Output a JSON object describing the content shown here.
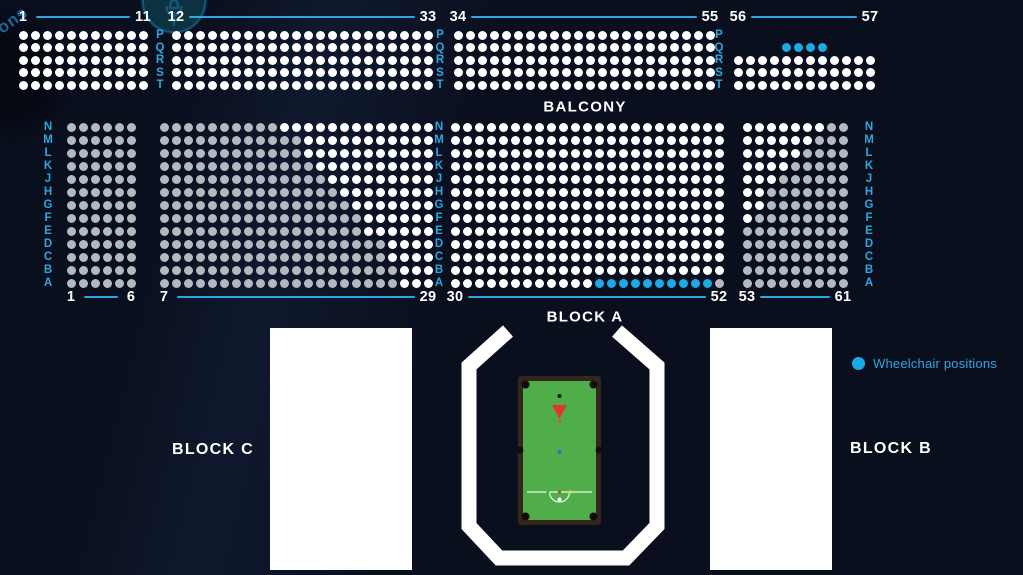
{
  "colors": {
    "background": "#0a0f1e",
    "accent_blue": "#2da7e0",
    "seat_available": "#ffffff",
    "seat_unavailable": "#b4b8bf",
    "seat_wheelchair": "#1da9e6",
    "block_fill": "#ffffff",
    "arena_outline": "#ffffff",
    "table_felt": "#4fae4a",
    "table_frame": "#35261b",
    "triangle_red": "#e0392b"
  },
  "labels": {
    "balcony": "BALCONY",
    "block_a": "BLOCK A",
    "block_b": "BLOCK B",
    "block_c": "BLOCK C"
  },
  "legend": {
    "wheelchair_label": "Wheelchair positions"
  },
  "watermark": {
    "text": "ions"
  },
  "seat_map": {
    "sections": [
      {
        "id": "balcony-1-11",
        "first_label": "1",
        "last_label": "11",
        "x": 23,
        "y": 35,
        "pitch_x": 12,
        "pitch_y": 12.5,
        "label_y": 17,
        "rows": [
          {
            "row": "P",
            "seats": "WWWWWWWWWWW"
          },
          {
            "row": "Q",
            "seats": "WWWWWWWWWWW"
          },
          {
            "row": "R",
            "seats": "WWWWWWWWWWW"
          },
          {
            "row": "S",
            "seats": "WWWWWWWWWWW"
          },
          {
            "row": "T",
            "seats": "WWWWWWWWWWW"
          }
        ]
      },
      {
        "id": "balcony-12-33",
        "first_label": "12",
        "last_label": "33",
        "x": 176,
        "y": 35,
        "pitch_x": 12,
        "pitch_y": 12.5,
        "label_y": 17,
        "rows": [
          {
            "row": "P",
            "seats": "WWWWWWWWWWWWWWWWWWWWWW"
          },
          {
            "row": "Q",
            "seats": "WWWWWWWWWWWWWWWWWWWWWW"
          },
          {
            "row": "R",
            "seats": "WWWWWWWWWWWWWWWWWWWWWW"
          },
          {
            "row": "S",
            "seats": "WWWWWWWWWWWWWWWWWWWWWW"
          },
          {
            "row": "T",
            "seats": "WWWWWWWWWWWWWWWWWWWWWW"
          }
        ]
      },
      {
        "id": "balcony-34-55",
        "first_label": "34",
        "last_label": "55",
        "x": 458,
        "y": 35,
        "pitch_x": 12,
        "pitch_y": 12.5,
        "label_y": 17,
        "rows": [
          {
            "row": "P",
            "seats": "WWWWWWWWWWWWWWWWWWWWWW"
          },
          {
            "row": "Q",
            "seats": "WWWWWWWWWWWWWWWWWWWWWW"
          },
          {
            "row": "R",
            "seats": "WWWWWWWWWWWWWWWWWWWWWW"
          },
          {
            "row": "S",
            "seats": "WWWWWWWWWWWWWWWWWWWWWW"
          },
          {
            "row": "T",
            "seats": "WWWWWWWWWWWWWWWWWWWWWW"
          }
        ]
      },
      {
        "id": "balcony-56-57",
        "first_label": "56",
        "last_label": "57",
        "x": 738,
        "y": 35,
        "pitch_x": 12,
        "pitch_y": 12.5,
        "label_y": 17,
        "rows": [
          {
            "row": "P",
            "seats": ""
          },
          {
            "row": "Q",
            "seats": "....BBBB"
          },
          {
            "row": "R",
            "seats": "WWWWWWWWWWWW"
          },
          {
            "row": "S",
            "seats": "WWWWWWWWWWWW"
          },
          {
            "row": "T",
            "seats": "WWWWWWWWWWWW"
          }
        ]
      },
      {
        "id": "floor-1-6",
        "first_label": "1",
        "last_label": "6",
        "x": 71,
        "y": 127,
        "pitch_x": 12,
        "pitch_y": 13,
        "label_y": 297,
        "rows": [
          {
            "row": "N",
            "seats": "GGGGGG"
          },
          {
            "row": "M",
            "seats": "GGGGGG"
          },
          {
            "row": "L",
            "seats": "GGGGGG"
          },
          {
            "row": "K",
            "seats": "GGGGGG"
          },
          {
            "row": "J",
            "seats": "GGGGGG"
          },
          {
            "row": "H",
            "seats": "GGGGGG"
          },
          {
            "row": "G",
            "seats": "GGGGGG"
          },
          {
            "row": "F",
            "seats": "GGGGGG"
          },
          {
            "row": "E",
            "seats": "GGGGGG"
          },
          {
            "row": "D",
            "seats": "GGGGGG"
          },
          {
            "row": "C",
            "seats": "GGGGGG"
          },
          {
            "row": "B",
            "seats": "GGGGGG"
          },
          {
            "row": "A",
            "seats": "GGGGGG"
          }
        ]
      },
      {
        "id": "floor-7-29",
        "first_label": "7",
        "last_label": "29",
        "x": 164,
        "y": 127,
        "pitch_x": 12,
        "pitch_y": 13,
        "label_y": 297,
        "rows": [
          {
            "row": "N",
            "seats": "GGGGGGGGGGWWWWWWWWWWWWW"
          },
          {
            "row": "M",
            "seats": "GGGGGGGGGGGGWWWWWWWWWWW"
          },
          {
            "row": "L",
            "seats": "GGGGGGGGGGGGWWWWWWWWWWW"
          },
          {
            "row": "K",
            "seats": "GGGGGGGGGGGGGWWWWWWWWWW"
          },
          {
            "row": "J",
            "seats": "GGGGGGGGGGGGGGWWWWWWWWW"
          },
          {
            "row": "H",
            "seats": "GGGGGGGGGGGGGGGWWWWWWWW"
          },
          {
            "row": "G",
            "seats": "GGGGGGGGGGGGGGGGWWWWWWW"
          },
          {
            "row": "F",
            "seats": "GGGGGGGGGGGGGGGGGWWWWWW"
          },
          {
            "row": "E",
            "seats": "GGGGGGGGGGGGGGGGGWWWWWW"
          },
          {
            "row": "D",
            "seats": "GGGGGGGGGGGGGGGGGGGWWWW"
          },
          {
            "row": "C",
            "seats": "GGGGGGGGGGGGGGGGGGGWWWW"
          },
          {
            "row": "B",
            "seats": "GGGGGGGGGGGGGGGGGGGGWWW"
          },
          {
            "row": "A",
            "seats": "GGGGGGGGGGGGGGGGGGGGWWW"
          }
        ]
      },
      {
        "id": "floor-30-52",
        "first_label": "30",
        "last_label": "52",
        "x": 455,
        "y": 127,
        "pitch_x": 12,
        "pitch_y": 13,
        "label_y": 297,
        "rows": [
          {
            "row": "N",
            "seats": "WWWWWWWWWWWWWWWWWWWWWWW"
          },
          {
            "row": "M",
            "seats": "WWWWWWWWWWWWWWWWWWWWWWW"
          },
          {
            "row": "L",
            "seats": "WWWWWWWWWWWWWWWWWWWWWWW"
          },
          {
            "row": "K",
            "seats": "WWWWWWWWWWWWWWWWWWWWWWW"
          },
          {
            "row": "J",
            "seats": "WWWWWWWWWWWWWWWWWWWWWWW"
          },
          {
            "row": "H",
            "seats": "WWWWWWWWWWWWWWWWWWWWWWW"
          },
          {
            "row": "G",
            "seats": "WWWWWWWWWWWWWWWWWWWWWWW"
          },
          {
            "row": "F",
            "seats": "WWWWWWWWWWWWWWWWWWWWWWW"
          },
          {
            "row": "E",
            "seats": "WWWWWWWWWWWWWWWWWWWWWWW"
          },
          {
            "row": "D",
            "seats": "WWWWWWWWWWWWWWWWWWWWWWW"
          },
          {
            "row": "C",
            "seats": "WWWWWWWWWWWWWWWWWWWWWWW"
          },
          {
            "row": "B",
            "seats": "WWWWWWWWWWWWWWWWWWWWWWW"
          },
          {
            "row": "A",
            "seats": "WWWWWWWWWWWWBBBBBBBBBBG"
          }
        ]
      },
      {
        "id": "floor-53-61",
        "first_label": "53",
        "last_label": "61",
        "x": 747,
        "y": 127,
        "pitch_x": 12,
        "pitch_y": 13,
        "label_y": 297,
        "rows": [
          {
            "row": "N",
            "seats": "WWWWWWWGG"
          },
          {
            "row": "M",
            "seats": "WWWWWWGGG"
          },
          {
            "row": "L",
            "seats": "WWWWWGGGG"
          },
          {
            "row": "K",
            "seats": "WWWWGGGGG"
          },
          {
            "row": "J",
            "seats": "WWWGGGGGG"
          },
          {
            "row": "H",
            "seats": "WWGGGGGGG"
          },
          {
            "row": "G",
            "seats": "WWGGGGGGG"
          },
          {
            "row": "F",
            "seats": "WGGGGGGGG"
          },
          {
            "row": "E",
            "seats": "GGGGGGGGG"
          },
          {
            "row": "D",
            "seats": "GGGGGGGGG"
          },
          {
            "row": "C",
            "seats": "GGGGGGGGG"
          },
          {
            "row": "B",
            "seats": "GGGGGGGGG"
          },
          {
            "row": "A",
            "seats": "GGGGGGGGG"
          }
        ]
      }
    ],
    "row_label_columns": [
      {
        "x": 160,
        "y": 35,
        "pitch": 12.5,
        "letters": [
          "P",
          "Q",
          "R",
          "S",
          "T"
        ]
      },
      {
        "x": 440,
        "y": 35,
        "pitch": 12.5,
        "letters": [
          "P",
          "Q",
          "R",
          "S",
          "T"
        ]
      },
      {
        "x": 719,
        "y": 35,
        "pitch": 12.5,
        "letters": [
          "P",
          "Q",
          "R",
          "S",
          "T"
        ]
      },
      {
        "x": 48,
        "y": 127,
        "pitch": 13,
        "letters": [
          "N",
          "M",
          "L",
          "K",
          "J",
          "H",
          "G",
          "F",
          "E",
          "D",
          "C",
          "B",
          "A"
        ]
      },
      {
        "x": 439,
        "y": 127,
        "pitch": 13,
        "letters": [
          "N",
          "M",
          "L",
          "K",
          "J",
          "H",
          "G",
          "F",
          "E",
          "D",
          "C",
          "B",
          "A"
        ]
      },
      {
        "x": 869,
        "y": 127,
        "pitch": 13,
        "letters": [
          "N",
          "M",
          "L",
          "K",
          "J",
          "H",
          "G",
          "F",
          "E",
          "D",
          "C",
          "B",
          "A"
        ]
      }
    ]
  }
}
